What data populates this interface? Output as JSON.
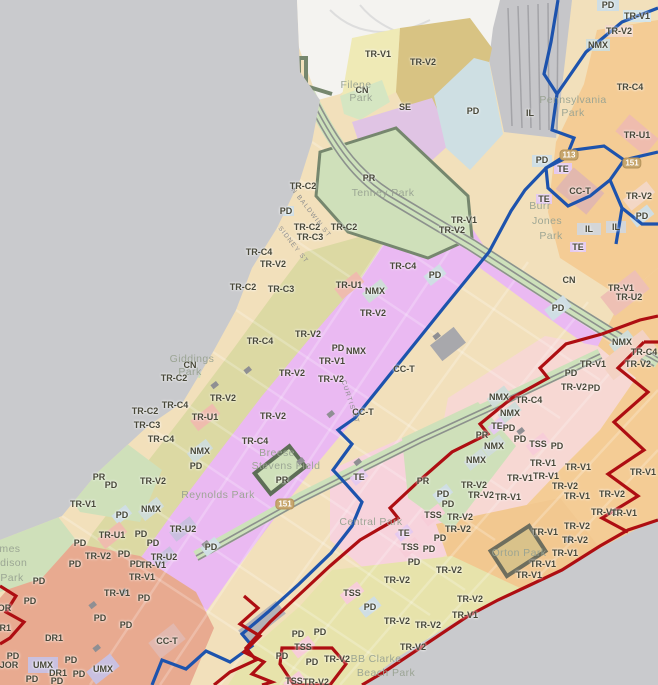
{
  "map": {
    "description": "City zoning district map with district boundary overlays",
    "colors": {
      "lake": "#c9cacd",
      "land_cream": "#f2e0bb",
      "olive_trv2": "#dcd9a3",
      "orange_trc4": "#f4cc95",
      "khaki_trv2": "#d8c383",
      "magenta_pd": "#eab9f2",
      "pink_trv1": "#f7d8d3",
      "yellow_trv2": "#e7e3ab",
      "salmon_dr1": "#e8aa90",
      "park_green": "#cfe0ba",
      "se_purple": "#e0c4e4",
      "pd_blue": "#cedfe3",
      "rail_gray": "#c6c6c9",
      "boundary_blue": "#1d53ad",
      "boundary_red": "#ae0e12"
    },
    "labels": [
      {
        "t": "PD",
        "x": 608,
        "y": 5,
        "k": "zone"
      },
      {
        "t": "TR-V1",
        "x": 637,
        "y": 16,
        "k": "zone"
      },
      {
        "t": "TR-V2",
        "x": 619,
        "y": 31,
        "k": "zone"
      },
      {
        "t": "NMX",
        "x": 598,
        "y": 45,
        "k": "zone"
      },
      {
        "t": "TR-V1",
        "x": 378,
        "y": 54,
        "k": "zone"
      },
      {
        "t": "TR-V2",
        "x": 423,
        "y": 62,
        "k": "zone"
      },
      {
        "t": "TR-C4",
        "x": 630,
        "y": 87,
        "k": "zone"
      },
      {
        "t": "CN",
        "x": 362,
        "y": 90,
        "k": "zone"
      },
      {
        "t": "SE",
        "x": 405,
        "y": 107,
        "k": "zone"
      },
      {
        "t": "PD",
        "x": 473,
        "y": 111,
        "k": "zone"
      },
      {
        "t": "IL",
        "x": 530,
        "y": 113,
        "k": "zone"
      },
      {
        "t": "TR-U1",
        "x": 637,
        "y": 135,
        "k": "zone"
      },
      {
        "t": "PD",
        "x": 542,
        "y": 160,
        "k": "zone"
      },
      {
        "t": "TE",
        "x": 563,
        "y": 169,
        "k": "zone"
      },
      {
        "t": "PR",
        "x": 369,
        "y": 178,
        "k": "zone"
      },
      {
        "t": "TR-C2",
        "x": 303,
        "y": 186,
        "k": "zone"
      },
      {
        "t": "CC-T",
        "x": 580,
        "y": 191,
        "k": "zone"
      },
      {
        "t": "TR-V2",
        "x": 639,
        "y": 196,
        "k": "zone"
      },
      {
        "t": "TE",
        "x": 544,
        "y": 199,
        "k": "zone"
      },
      {
        "t": "PD",
        "x": 286,
        "y": 211,
        "k": "zone"
      },
      {
        "t": "PD",
        "x": 642,
        "y": 216,
        "k": "zone"
      },
      {
        "t": "TR-V1",
        "x": 464,
        "y": 220,
        "k": "zone"
      },
      {
        "t": "IL",
        "x": 616,
        "y": 227,
        "k": "zone"
      },
      {
        "t": "TR-C2",
        "x": 307,
        "y": 227,
        "k": "zone"
      },
      {
        "t": "TR-C2",
        "x": 344,
        "y": 227,
        "k": "zone"
      },
      {
        "t": "TR-V2",
        "x": 452,
        "y": 230,
        "k": "zone"
      },
      {
        "t": "IL",
        "x": 589,
        "y": 229,
        "k": "zone"
      },
      {
        "t": "TR-C3",
        "x": 310,
        "y": 237,
        "k": "zone"
      },
      {
        "t": "TE",
        "x": 578,
        "y": 247,
        "k": "zone"
      },
      {
        "t": "TR-C4",
        "x": 259,
        "y": 252,
        "k": "zone"
      },
      {
        "t": "TR-V2",
        "x": 273,
        "y": 264,
        "k": "zone"
      },
      {
        "t": "TR-C4",
        "x": 403,
        "y": 266,
        "k": "zone"
      },
      {
        "t": "PD",
        "x": 435,
        "y": 275,
        "k": "zone"
      },
      {
        "t": "CN",
        "x": 569,
        "y": 280,
        "k": "zone"
      },
      {
        "t": "TR-U1",
        "x": 349,
        "y": 285,
        "k": "zone"
      },
      {
        "t": "TR-C2",
        "x": 243,
        "y": 287,
        "k": "zone"
      },
      {
        "t": "TR-V1",
        "x": 621,
        "y": 288,
        "k": "zone"
      },
      {
        "t": "TR-C3",
        "x": 281,
        "y": 289,
        "k": "zone"
      },
      {
        "t": "NMX",
        "x": 375,
        "y": 291,
        "k": "zone"
      },
      {
        "t": "TR-U2",
        "x": 629,
        "y": 297,
        "k": "zone"
      },
      {
        "t": "PD",
        "x": 558,
        "y": 308,
        "k": "zone"
      },
      {
        "t": "TR-V2",
        "x": 373,
        "y": 313,
        "k": "zone"
      },
      {
        "t": "TR-V2",
        "x": 308,
        "y": 334,
        "k": "zone"
      },
      {
        "t": "TR-C4",
        "x": 260,
        "y": 341,
        "k": "zone"
      },
      {
        "t": "NMX",
        "x": 622,
        "y": 342,
        "k": "zone"
      },
      {
        "t": "PD",
        "x": 338,
        "y": 348,
        "k": "zone"
      },
      {
        "t": "TR-C4",
        "x": 644,
        "y": 352,
        "k": "zone"
      },
      {
        "t": "NMX",
        "x": 356,
        "y": 351,
        "k": "zone"
      },
      {
        "t": "TR-V1",
        "x": 332,
        "y": 361,
        "k": "zone"
      },
      {
        "t": "CN",
        "x": 190,
        "y": 365,
        "k": "zone"
      },
      {
        "t": "TR-V1",
        "x": 593,
        "y": 364,
        "k": "zone"
      },
      {
        "t": "TR-V2",
        "x": 638,
        "y": 364,
        "k": "zone"
      },
      {
        "t": "TR-V2",
        "x": 292,
        "y": 373,
        "k": "zone"
      },
      {
        "t": "PD",
        "x": 571,
        "y": 373,
        "k": "zone"
      },
      {
        "t": "TR-C2",
        "x": 174,
        "y": 378,
        "k": "zone"
      },
      {
        "t": "TR-V2",
        "x": 331,
        "y": 379,
        "k": "zone"
      },
      {
        "t": "TR-V2",
        "x": 574,
        "y": 387,
        "k": "zone"
      },
      {
        "t": "PD",
        "x": 594,
        "y": 388,
        "k": "zone"
      },
      {
        "t": "TR-V2",
        "x": 223,
        "y": 398,
        "k": "zone"
      },
      {
        "t": "NMX",
        "x": 499,
        "y": 397,
        "k": "zone"
      },
      {
        "t": "TR-C4",
        "x": 529,
        "y": 400,
        "k": "zone"
      },
      {
        "t": "TR-C4",
        "x": 175,
        "y": 405,
        "k": "zone"
      },
      {
        "t": "TR-C2",
        "x": 145,
        "y": 411,
        "k": "zone"
      },
      {
        "t": "NMX",
        "x": 510,
        "y": 413,
        "k": "zone"
      },
      {
        "t": "TR-U1",
        "x": 205,
        "y": 417,
        "k": "zone"
      },
      {
        "t": "TR-V2",
        "x": 273,
        "y": 416,
        "k": "zone"
      },
      {
        "t": "CC-T",
        "x": 404,
        "y": 369,
        "k": "zone"
      },
      {
        "t": "CC-T",
        "x": 363,
        "y": 412,
        "k": "zone"
      },
      {
        "t": "TR-C3",
        "x": 147,
        "y": 425,
        "k": "zone"
      },
      {
        "t": "TE",
        "x": 497,
        "y": 426,
        "k": "zone"
      },
      {
        "t": "PD",
        "x": 509,
        "y": 428,
        "k": "zone"
      },
      {
        "t": "PR",
        "x": 482,
        "y": 435,
        "k": "zone"
      },
      {
        "t": "TR-C4",
        "x": 161,
        "y": 439,
        "k": "zone"
      },
      {
        "t": "TR-C4",
        "x": 255,
        "y": 441,
        "k": "zone"
      },
      {
        "t": "PD",
        "x": 520,
        "y": 439,
        "k": "zone"
      },
      {
        "t": "TSS",
        "x": 538,
        "y": 444,
        "k": "zone"
      },
      {
        "t": "PD",
        "x": 557,
        "y": 446,
        "k": "zone"
      },
      {
        "t": "NMX",
        "x": 494,
        "y": 446,
        "k": "zone"
      },
      {
        "t": "NMX",
        "x": 200,
        "y": 451,
        "k": "zone"
      },
      {
        "t": "NMX",
        "x": 476,
        "y": 460,
        "k": "zone"
      },
      {
        "t": "TR-V1",
        "x": 543,
        "y": 463,
        "k": "zone"
      },
      {
        "t": "TR-V1",
        "x": 578,
        "y": 467,
        "k": "zone"
      },
      {
        "t": "PD",
        "x": 196,
        "y": 466,
        "k": "zone"
      },
      {
        "t": "TR-V1",
        "x": 643,
        "y": 472,
        "k": "zone"
      },
      {
        "t": "TR-V1",
        "x": 520,
        "y": 478,
        "k": "zone"
      },
      {
        "t": "TR-V1",
        "x": 546,
        "y": 476,
        "k": "zone"
      },
      {
        "t": "PR",
        "x": 99,
        "y": 477,
        "k": "zone"
      },
      {
        "t": "TE",
        "x": 359,
        "y": 477,
        "k": "zone"
      },
      {
        "t": "PR",
        "x": 423,
        "y": 481,
        "k": "zone"
      },
      {
        "t": "TR-V2",
        "x": 153,
        "y": 481,
        "k": "zone"
      },
      {
        "t": "PR",
        "x": 282,
        "y": 480,
        "k": "zone"
      },
      {
        "t": "PD",
        "x": 111,
        "y": 485,
        "k": "zone"
      },
      {
        "t": "TR-V2",
        "x": 474,
        "y": 485,
        "k": "zone"
      },
      {
        "t": "TR-V2",
        "x": 565,
        "y": 486,
        "k": "zone"
      },
      {
        "t": "PD",
        "x": 443,
        "y": 494,
        "k": "zone"
      },
      {
        "t": "TR-V2",
        "x": 612,
        "y": 494,
        "k": "zone"
      },
      {
        "t": "TR-V2",
        "x": 481,
        "y": 495,
        "k": "zone"
      },
      {
        "t": "TR-V1",
        "x": 508,
        "y": 497,
        "k": "zone"
      },
      {
        "t": "TR-V1",
        "x": 577,
        "y": 496,
        "k": "zone"
      },
      {
        "t": "PD",
        "x": 448,
        "y": 504,
        "k": "zone"
      },
      {
        "t": "TR-V1",
        "x": 83,
        "y": 504,
        "k": "zone"
      },
      {
        "t": "TR-V1",
        "x": 604,
        "y": 512,
        "k": "zone"
      },
      {
        "t": "NMX",
        "x": 151,
        "y": 509,
        "k": "zone"
      },
      {
        "t": "TR-V1",
        "x": 624,
        "y": 513,
        "k": "zone"
      },
      {
        "t": "PD",
        "x": 122,
        "y": 515,
        "k": "zone"
      },
      {
        "t": "TSS",
        "x": 433,
        "y": 515,
        "k": "zone"
      },
      {
        "t": "TR-V2",
        "x": 460,
        "y": 517,
        "k": "zone"
      },
      {
        "t": "TR-V2",
        "x": 577,
        "y": 526,
        "k": "zone"
      },
      {
        "t": "TR-U2",
        "x": 183,
        "y": 529,
        "k": "zone"
      },
      {
        "t": "TR-V2",
        "x": 458,
        "y": 529,
        "k": "zone"
      },
      {
        "t": "TR-V1",
        "x": 545,
        "y": 532,
        "k": "zone"
      },
      {
        "t": "TE",
        "x": 404,
        "y": 533,
        "k": "zone"
      },
      {
        "t": "TR-U1",
        "x": 112,
        "y": 535,
        "k": "zone"
      },
      {
        "t": "PD",
        "x": 141,
        "y": 534,
        "k": "zone"
      },
      {
        "t": "PD",
        "x": 440,
        "y": 538,
        "k": "zone"
      },
      {
        "t": "TR-V2",
        "x": 575,
        "y": 540,
        "k": "zone"
      },
      {
        "t": "PD",
        "x": 80,
        "y": 543,
        "k": "zone"
      },
      {
        "t": "PD",
        "x": 153,
        "y": 543,
        "k": "zone"
      },
      {
        "t": "TSS",
        "x": 410,
        "y": 547,
        "k": "zone"
      },
      {
        "t": "PD",
        "x": 211,
        "y": 547,
        "k": "zone"
      },
      {
        "t": "PD",
        "x": 429,
        "y": 549,
        "k": "zone"
      },
      {
        "t": "TR-V1",
        "x": 565,
        "y": 553,
        "k": "zone"
      },
      {
        "t": "PD",
        "x": 124,
        "y": 554,
        "k": "zone"
      },
      {
        "t": "TR-V2",
        "x": 98,
        "y": 556,
        "k": "zone"
      },
      {
        "t": "TR-U2",
        "x": 164,
        "y": 557,
        "k": "zone"
      },
      {
        "t": "PD",
        "x": 414,
        "y": 562,
        "k": "zone"
      },
      {
        "t": "TR-V1",
        "x": 543,
        "y": 564,
        "k": "zone"
      },
      {
        "t": "PD",
        "x": 75,
        "y": 564,
        "k": "zone"
      },
      {
        "t": "PD",
        "x": 136,
        "y": 564,
        "k": "zone"
      },
      {
        "t": "TR-V1",
        "x": 153,
        "y": 565,
        "k": "zone"
      },
      {
        "t": "TR-V2",
        "x": 449,
        "y": 570,
        "k": "zone"
      },
      {
        "t": "TR-V1",
        "x": 529,
        "y": 575,
        "k": "zone"
      },
      {
        "t": "TR-V1",
        "x": 142,
        "y": 577,
        "k": "zone"
      },
      {
        "t": "TR-V2",
        "x": 397,
        "y": 580,
        "k": "zone"
      },
      {
        "t": "PD",
        "x": 39,
        "y": 581,
        "k": "zone"
      },
      {
        "t": "TSS",
        "x": 352,
        "y": 593,
        "k": "zone"
      },
      {
        "t": "TR-V1",
        "x": 117,
        "y": 593,
        "k": "zone"
      },
      {
        "t": "PD",
        "x": 144,
        "y": 598,
        "k": "zone"
      },
      {
        "t": "TR-V2",
        "x": 470,
        "y": 599,
        "k": "zone"
      },
      {
        "t": "PD",
        "x": 30,
        "y": 601,
        "k": "zone"
      },
      {
        "t": "PD",
        "x": 370,
        "y": 607,
        "k": "zone"
      },
      {
        "t": "JOR",
        "x": 2,
        "y": 608,
        "k": "zone"
      },
      {
        "t": "TR-V1",
        "x": 465,
        "y": 615,
        "k": "zone"
      },
      {
        "t": "PD",
        "x": 100,
        "y": 618,
        "k": "zone"
      },
      {
        "t": "TR-V2",
        "x": 397,
        "y": 621,
        "k": "zone"
      },
      {
        "t": "TR-V2",
        "x": 428,
        "y": 625,
        "k": "zone"
      },
      {
        "t": "PD",
        "x": 126,
        "y": 625,
        "k": "zone"
      },
      {
        "t": "DR1",
        "x": 2,
        "y": 628,
        "k": "zone"
      },
      {
        "t": "PD",
        "x": 320,
        "y": 632,
        "k": "zone"
      },
      {
        "t": "PD",
        "x": 298,
        "y": 634,
        "k": "zone"
      },
      {
        "t": "DR1",
        "x": 54,
        "y": 638,
        "k": "zone"
      },
      {
        "t": "CC-T",
        "x": 167,
        "y": 641,
        "k": "zone"
      },
      {
        "t": "TR-V2",
        "x": 413,
        "y": 647,
        "k": "zone"
      },
      {
        "t": "TSS",
        "x": 303,
        "y": 647,
        "k": "zone"
      },
      {
        "t": "PD",
        "x": 13,
        "y": 656,
        "k": "zone"
      },
      {
        "t": "PD",
        "x": 282,
        "y": 656,
        "k": "zone"
      },
      {
        "t": "TR-V2",
        "x": 337,
        "y": 659,
        "k": "zone"
      },
      {
        "t": "PD",
        "x": 71,
        "y": 660,
        "k": "zone"
      },
      {
        "t": "PD",
        "x": 312,
        "y": 662,
        "k": "zone"
      },
      {
        "t": "UMX",
        "x": 43,
        "y": 665,
        "k": "zone"
      },
      {
        "t": "JOR",
        "x": 9,
        "y": 665,
        "k": "zone"
      },
      {
        "t": "UMX",
        "x": 103,
        "y": 669,
        "k": "zone"
      },
      {
        "t": "DR1",
        "x": 58,
        "y": 673,
        "k": "zone"
      },
      {
        "t": "PD",
        "x": 79,
        "y": 674,
        "k": "zone"
      },
      {
        "t": "PD",
        "x": 32,
        "y": 679,
        "k": "zone"
      },
      {
        "t": "PD",
        "x": 57,
        "y": 681,
        "k": "zone"
      },
      {
        "t": "TSS",
        "x": 294,
        "y": 681,
        "k": "zone"
      },
      {
        "t": "TR-V2",
        "x": 316,
        "y": 682,
        "k": "zone"
      },
      {
        "t": "Filene",
        "x": 356,
        "y": 85,
        "k": "park"
      },
      {
        "t": "Park",
        "x": 361,
        "y": 98,
        "k": "park"
      },
      {
        "t": "Pennsylvania",
        "x": 573,
        "y": 100,
        "k": "park"
      },
      {
        "t": "Park",
        "x": 573,
        "y": 113,
        "k": "park"
      },
      {
        "t": "Tenney Park",
        "x": 383,
        "y": 193,
        "k": "park"
      },
      {
        "t": "Burr",
        "x": 540,
        "y": 206,
        "k": "park"
      },
      {
        "t": "Jones",
        "x": 547,
        "y": 221,
        "k": "park"
      },
      {
        "t": "Park",
        "x": 551,
        "y": 236,
        "k": "park"
      },
      {
        "t": "Giddings",
        "x": 192,
        "y": 359,
        "k": "park"
      },
      {
        "t": "Park",
        "x": 190,
        "y": 372,
        "k": "park"
      },
      {
        "t": "Breese",
        "x": 277,
        "y": 453,
        "k": "park"
      },
      {
        "t": "Stevens Field",
        "x": 286,
        "y": 466,
        "k": "park"
      },
      {
        "t": "Reynolds Park",
        "x": 218,
        "y": 495,
        "k": "park"
      },
      {
        "t": "Central Park",
        "x": 371,
        "y": 522,
        "k": "park"
      },
      {
        "t": "Orton Park",
        "x": 519,
        "y": 553,
        "k": "park"
      },
      {
        "t": "BB Clarke",
        "x": 376,
        "y": 659,
        "k": "park"
      },
      {
        "t": "Beach Park",
        "x": 386,
        "y": 673,
        "k": "park"
      },
      {
        "t": "James",
        "x": 4,
        "y": 549,
        "k": "park"
      },
      {
        "t": "Madison",
        "x": 6,
        "y": 563,
        "k": "park"
      },
      {
        "t": "Park",
        "x": 12,
        "y": 578,
        "k": "park"
      },
      {
        "t": "N BALDWIN ST",
        "x": 311,
        "y": 213,
        "k": "street",
        "r": 52
      },
      {
        "t": "SIDNEY ST",
        "x": 293,
        "y": 245,
        "k": "street",
        "r": 52
      },
      {
        "t": "CURTIS CT",
        "x": 350,
        "y": 402,
        "k": "street",
        "r": 72
      },
      {
        "t": "113",
        "x": 569,
        "y": 155,
        "k": "shield"
      },
      {
        "t": "151",
        "x": 632,
        "y": 163,
        "k": "shield"
      },
      {
        "t": "151",
        "x": 285,
        "y": 504,
        "k": "shield"
      }
    ]
  }
}
